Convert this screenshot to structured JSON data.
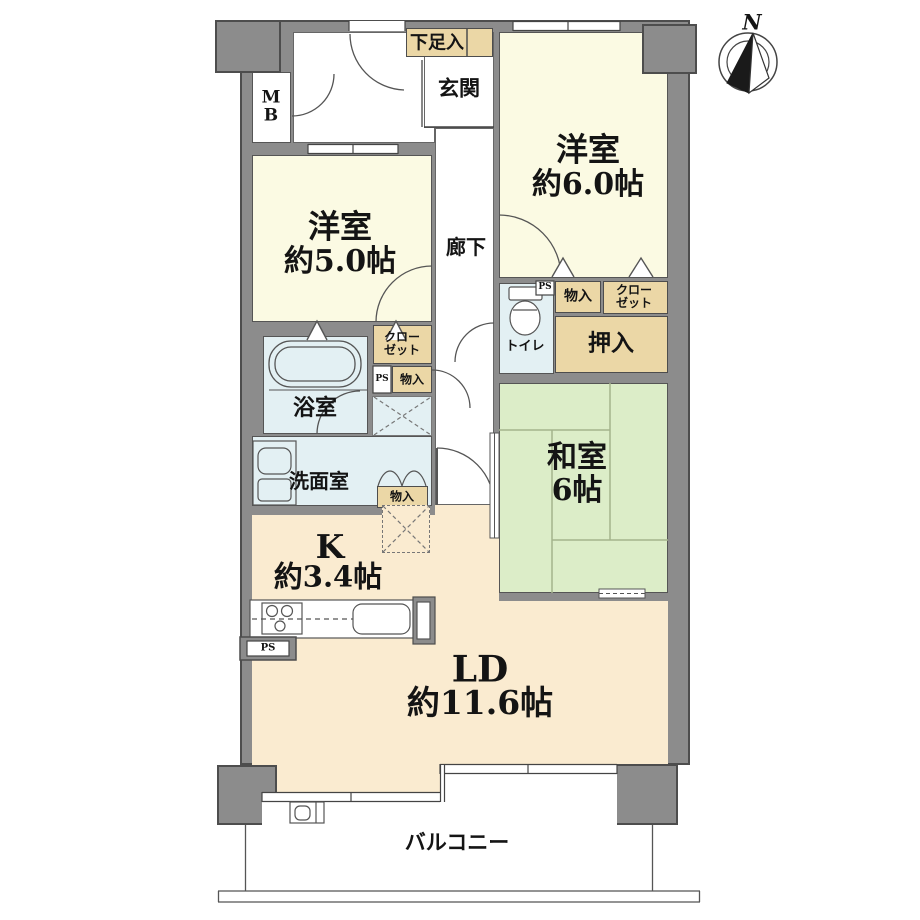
{
  "compass": {
    "north": "N"
  },
  "rooms": {
    "western6": {
      "name": "洋室",
      "size": "約6.0帖"
    },
    "western5": {
      "name": "洋室",
      "size": "約5.0帖"
    },
    "japanese": {
      "name": "和室",
      "size": "6帖"
    },
    "living": {
      "name": "LD",
      "size": "約11.6帖"
    },
    "kitchen": {
      "name": "K",
      "size": "約3.4帖"
    },
    "entrance": {
      "name": "玄関"
    },
    "hallway": {
      "name": "廊下"
    },
    "bathroom": {
      "name": "浴室"
    },
    "washroom": {
      "name": "洗面室"
    },
    "toilet": {
      "name": "トイレ"
    },
    "balcony": {
      "name": "バルコニー"
    }
  },
  "storage": {
    "shoe_box": "下足入",
    "closet_line1": "クロー",
    "closet_line2": "ゼット",
    "monoire": "物入",
    "oshiire": "押入",
    "ps": "PS",
    "mb_line1": "M",
    "mb_line2": "B"
  },
  "colors": {
    "wall": "#8c8c8c",
    "outline": "#4d4d4d",
    "western_room": "#FBFAE3",
    "japanese_room": "#DCEDC8",
    "living_dining": "#FAEBD0",
    "closet": "#EBD7A6",
    "wet_area": "#E3F0F3",
    "tatami_line": "#a3b38c"
  }
}
